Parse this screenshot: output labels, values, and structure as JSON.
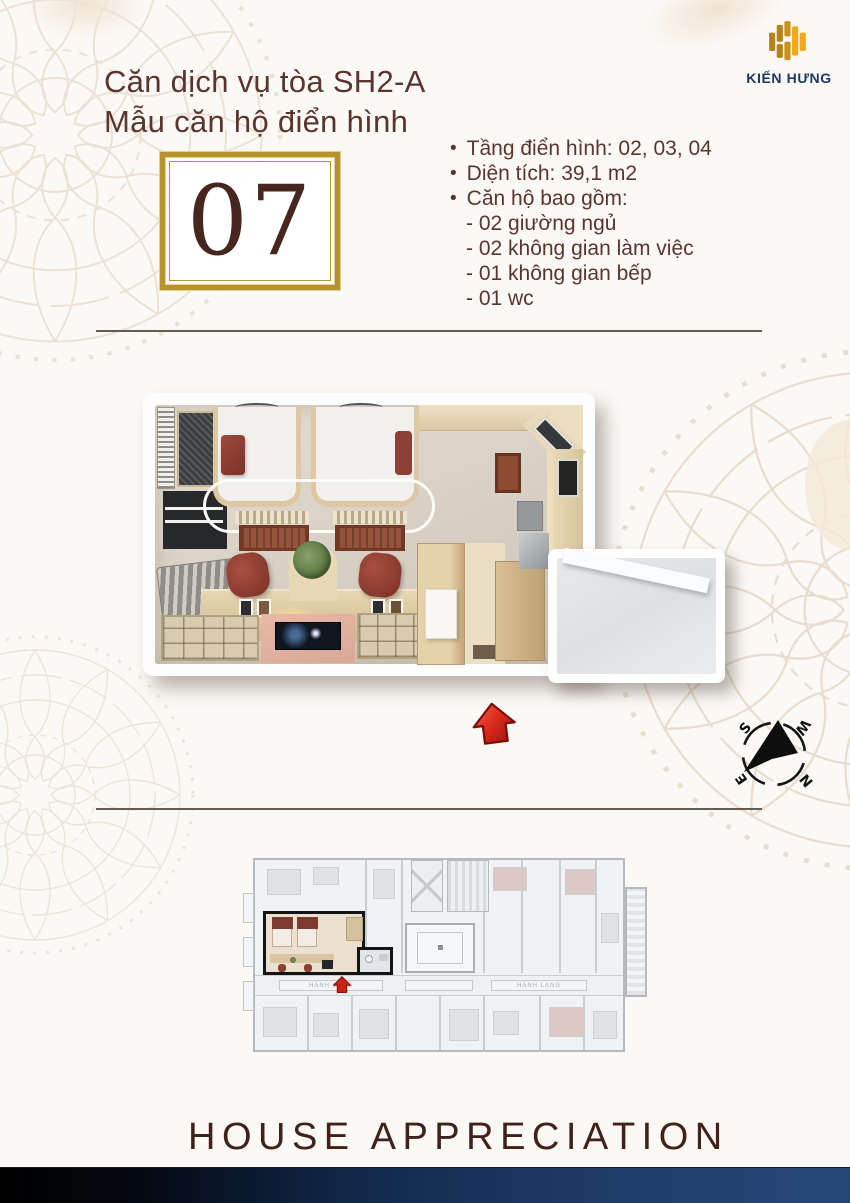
{
  "header": {
    "title_line1": "Căn dịch vụ tòa SH2-A",
    "title_line2": "Mẫu căn hộ điển hình"
  },
  "brand": {
    "name": "KIẾN HƯNG"
  },
  "unit": {
    "number": "07"
  },
  "specs": {
    "bullets": [
      "Tầng điển hình: 02, 03, 04",
      "Diện tích: 39,1 m2",
      "Căn hộ bao gồm:"
    ],
    "details": [
      "- 02 giường ngủ",
      "- 02 không gian làm việc",
      "- 01 không gian bếp",
      "- 01 wc"
    ]
  },
  "compass": {
    "north": "N",
    "south": "S",
    "east": "E",
    "west": "W"
  },
  "overview": {
    "corridor_label_left": "HÀNH LANG",
    "corridor_label_right": "HÀNH LANG"
  },
  "footer": {
    "tagline": "HOUSE APPRECIATION"
  },
  "colors": {
    "accent_gold": "#b8922e",
    "brand_navy": "#1c3763",
    "text_brown": "#5b342d",
    "highlight_red": "#d42a1e",
    "maroon": "#8a3c33"
  }
}
